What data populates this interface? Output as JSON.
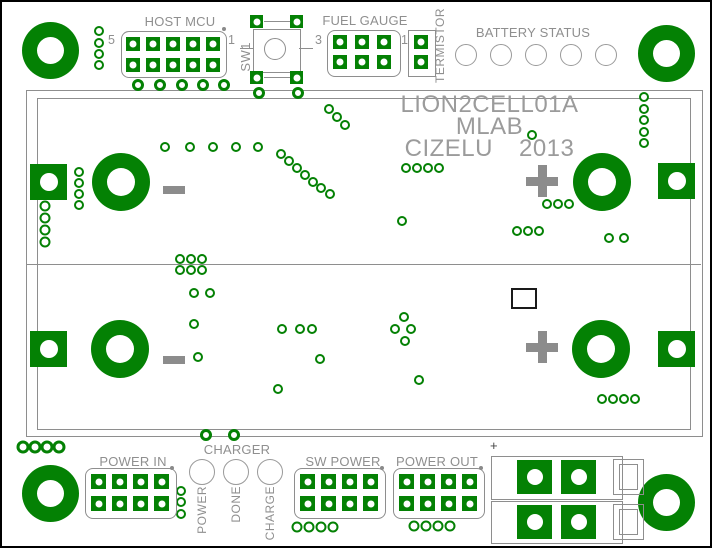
{
  "colors": {
    "copper": "#048104",
    "silk": "#8f8f8f",
    "outline": "#8e8e8e",
    "title": "#9b9b9b",
    "polarity": "#8c8c8c"
  },
  "title_block": {
    "product": "LION2CELL01A",
    "organization": "MLAB",
    "author": "CIZELU",
    "year": "2013"
  },
  "connectors": {
    "host_mcu": {
      "label": "HOST MCU",
      "pin_count": 10,
      "left_pin": "5",
      "right_pin": "1"
    },
    "fuel_gauge": {
      "label": "FUEL GAUGE",
      "pin_count": 6,
      "left_pin": "3",
      "right_pin": "1"
    },
    "termistor": {
      "label": "TERMISTOR",
      "pin_count": 2
    },
    "power_in": {
      "label": "POWER IN",
      "pin_count": 8
    },
    "sw_power": {
      "label": "SW POWER",
      "pin_count": 8
    },
    "power_out": {
      "label": "POWER OUT",
      "pin_count": 8
    }
  },
  "switch_sw1": {
    "label": "SW1"
  },
  "battery_status": {
    "label": "BATTERY STATUS",
    "led_count": 5
  },
  "charger": {
    "label": "CHARGER",
    "leds": [
      "POWER",
      "DONE",
      "CHARGE"
    ]
  },
  "battery_cells": {
    "negative_mark": "-",
    "positive_mark": "+"
  },
  "terminal_block": {
    "polarity_label": "+"
  },
  "vias": [
    [
      97,
      29
    ],
    [
      97,
      41
    ],
    [
      97,
      52
    ],
    [
      97,
      63
    ],
    [
      136,
      83,
      12
    ],
    [
      158,
      83,
      12
    ],
    [
      180,
      83,
      12
    ],
    [
      201,
      83,
      12
    ],
    [
      222,
      83,
      12
    ],
    [
      257,
      91,
      12
    ],
    [
      296,
      91,
      12
    ],
    [
      163,
      145
    ],
    [
      188,
      145
    ],
    [
      211,
      145
    ],
    [
      234,
      145
    ],
    [
      256,
      145
    ],
    [
      327,
      107
    ],
    [
      335,
      115
    ],
    [
      343,
      123
    ],
    [
      279,
      152
    ],
    [
      287,
      159
    ],
    [
      295,
      166
    ],
    [
      303,
      173
    ],
    [
      311,
      180
    ],
    [
      319,
      186
    ],
    [
      328,
      192
    ],
    [
      404,
      166
    ],
    [
      415,
      166
    ],
    [
      426,
      166
    ],
    [
      437,
      166
    ],
    [
      400,
      219
    ],
    [
      530,
      133
    ],
    [
      545,
      202
    ],
    [
      556,
      202
    ],
    [
      567,
      202
    ],
    [
      515,
      229
    ],
    [
      526,
      229
    ],
    [
      537,
      229
    ],
    [
      642,
      95
    ],
    [
      642,
      107
    ],
    [
      642,
      118
    ],
    [
      642,
      130
    ],
    [
      642,
      141
    ],
    [
      607,
      236
    ],
    [
      622,
      236
    ],
    [
      77,
      170
    ],
    [
      77,
      181
    ],
    [
      77,
      192
    ],
    [
      77,
      203
    ],
    [
      43,
      204,
      11
    ],
    [
      43,
      216,
      11
    ],
    [
      43,
      228,
      11
    ],
    [
      43,
      240,
      11
    ],
    [
      178,
      257
    ],
    [
      189,
      257
    ],
    [
      200,
      257
    ],
    [
      178,
      268
    ],
    [
      189,
      268
    ],
    [
      200,
      268
    ],
    [
      192,
      291
    ],
    [
      208,
      291
    ],
    [
      192,
      322
    ],
    [
      196,
      355
    ],
    [
      280,
      327
    ],
    [
      298,
      327
    ],
    [
      310,
      327
    ],
    [
      318,
      357
    ],
    [
      276,
      387
    ],
    [
      402,
      315
    ],
    [
      393,
      327
    ],
    [
      409,
      327
    ],
    [
      403,
      339
    ],
    [
      417,
      378
    ],
    [
      600,
      397
    ],
    [
      611,
      397
    ],
    [
      622,
      397
    ],
    [
      633,
      397
    ],
    [
      21,
      445,
      13
    ],
    [
      33,
      445,
      13
    ],
    [
      45,
      445,
      13
    ],
    [
      57,
      445,
      13
    ],
    [
      204,
      433,
      12
    ],
    [
      232,
      433,
      12
    ],
    [
      179,
      489
    ],
    [
      179,
      500
    ],
    [
      179,
      512
    ],
    [
      295,
      525,
      11
    ],
    [
      307,
      525,
      11
    ],
    [
      319,
      525,
      11
    ],
    [
      331,
      525,
      11
    ],
    [
      412,
      524,
      11
    ],
    [
      424,
      524,
      11
    ],
    [
      436,
      524,
      11
    ],
    [
      448,
      524,
      11
    ]
  ]
}
